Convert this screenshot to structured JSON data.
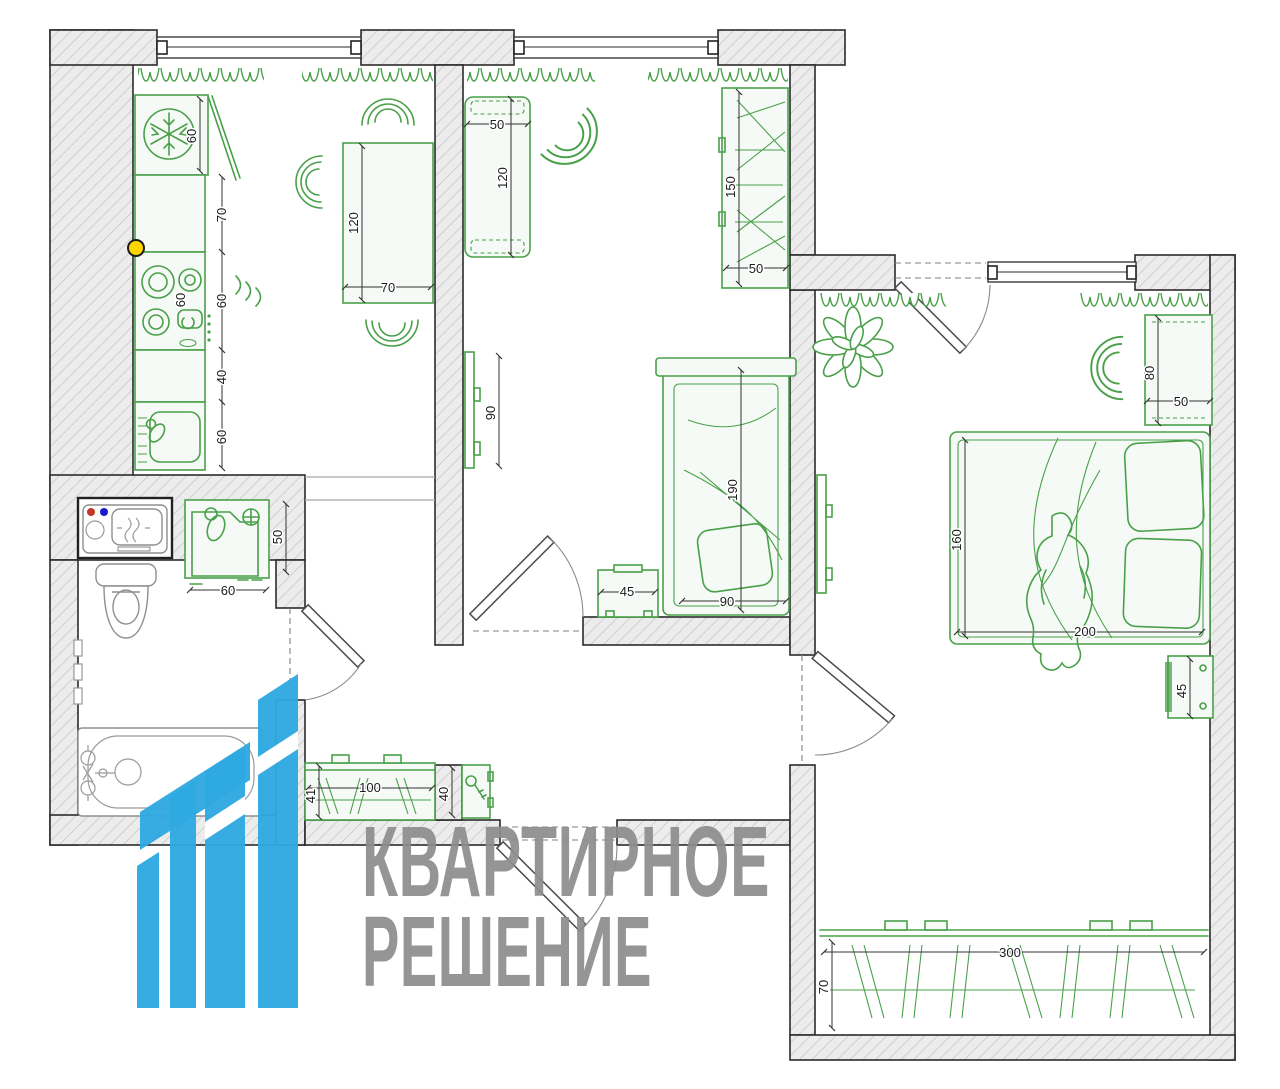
{
  "meta": {
    "title": "Apartment floor plan with furniture layout"
  },
  "colors": {
    "furniture_green": "#4aa04a",
    "wall_outline": "#2b2b2b",
    "hatch_fill": "#ececec",
    "logo_blue": "#2fa9e1",
    "watermark_gray": "#8d8d8d",
    "marker_yellow": "#ffd500",
    "marker_red": "#c0392b",
    "marker_blue": "#1a1acc"
  },
  "watermark": {
    "line1": "КВАРТИРНОЕ",
    "line2": "РЕШЕНИЕ"
  },
  "dims": {
    "k_fridge": "60",
    "k_70": "70",
    "k_stove": "60",
    "k_60a": "60",
    "k_40": "40",
    "k_60b": "60",
    "k_table_120": "120",
    "k_table_70": "70",
    "ba_50": "50",
    "ba_60": "60",
    "r_bench_50": "50",
    "r_bench_120": "120",
    "r_ward_150": "150",
    "r_ward_50": "50",
    "r_tv_90": "90",
    "r_bed_190": "190",
    "r_bed_90": "90",
    "r_night_45": "45",
    "bd_desk_80": "80",
    "bd_desk_50": "50",
    "bd_bed_160": "160",
    "bd_bed_200": "200",
    "bd_side_45": "45",
    "bd_ward_300": "300",
    "bd_ward_70": "70",
    "h_shoe_100": "100",
    "h_shoe_41": "41",
    "h_key_40": "40"
  }
}
